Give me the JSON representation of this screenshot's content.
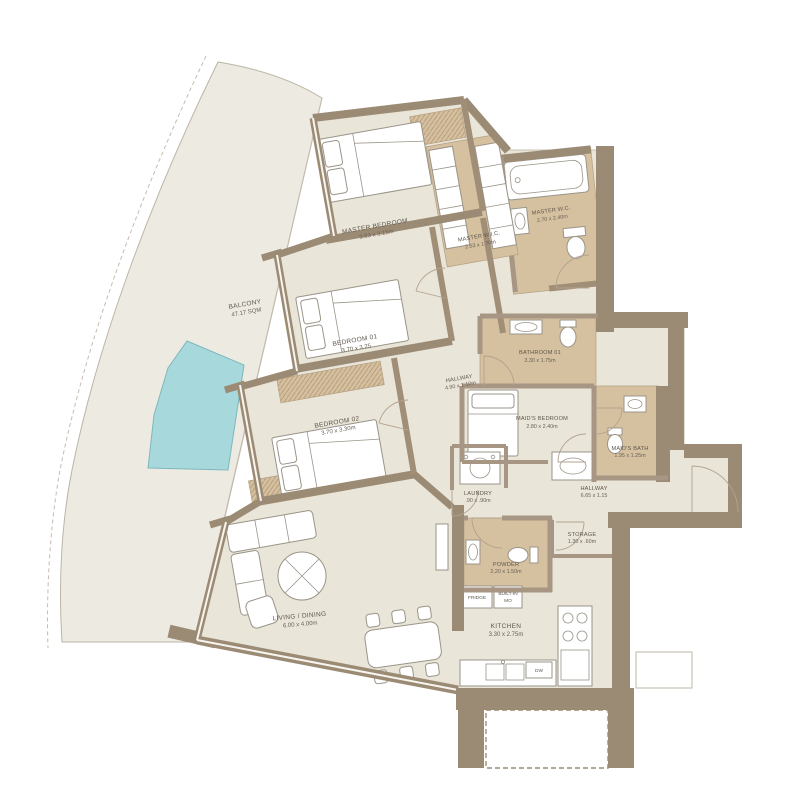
{
  "plan_title": "3 Bedroom + Maid Apartment Floor Plan",
  "rooms": {
    "balcony": {
      "name": "BALCONY",
      "dims": "47.17 SQM"
    },
    "master_bedroom": {
      "name": "MASTER BEDROOM",
      "dims": "3.83 x 3.15m"
    },
    "master_wic": {
      "name": "MASTER W.I.C.",
      "dims": "2.53 x 1.70m"
    },
    "master_wc": {
      "name": "MASTER W.C.",
      "dims": "2.70 x 2.40m"
    },
    "bedroom01": {
      "name": "BEDROOM 01",
      "dims": "3.70 x 3.25"
    },
    "hallway1": {
      "name": "HALLWAY",
      "dims": "4.90 x 1.10m"
    },
    "bedroom02": {
      "name": "BEDROOM 02",
      "dims": "3.70 x 3.30m"
    },
    "bathroom01": {
      "name": "BATHROOM 01",
      "dims": "3.30 x 1.75m"
    },
    "maids_bedroom": {
      "name": "MAID'S BEDROOM",
      "dims": "2.80 x 2.40m"
    },
    "maids_bath": {
      "name": "MAID'S BATH",
      "dims": "1.95 x 1.25m"
    },
    "laundry": {
      "name": "LAUNDRY",
      "dims": ".90 x .90m"
    },
    "hallway2": {
      "name": "HALLWAY",
      "dims": "6.65 x 1.15"
    },
    "storage": {
      "name": "STORAGE",
      "dims": "1.30 x .60m"
    },
    "powder": {
      "name": "POWDER",
      "dims": "2.20 x 1.50m"
    },
    "kitchen": {
      "name": "KITCHEN",
      "dims": "3.30 x 2.75m"
    },
    "living_dining": {
      "name": "LIVING / DINING",
      "dims": "6.00 x 4.00m"
    }
  },
  "appliances": {
    "fridge": "FRIDGE",
    "built_in_1": "BUILT-IN",
    "built_in_2": "MO",
    "dishwasher": "DW"
  },
  "colors": {
    "wall": "#9c8b74",
    "floor": "#eae5d9",
    "wet_floor": "#d5c0a0",
    "balcony_floor": "#edeae1",
    "pool": "#a7d8dc"
  }
}
